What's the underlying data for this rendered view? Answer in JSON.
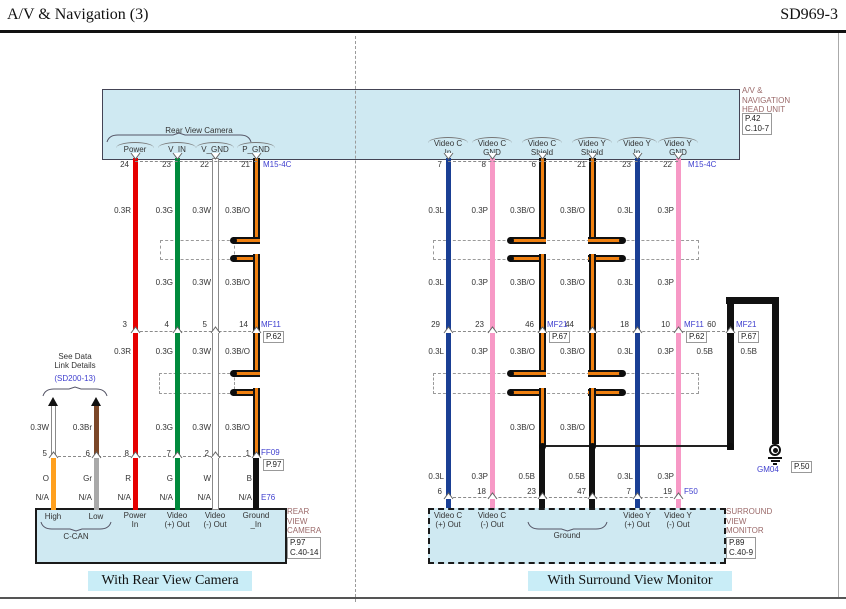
{
  "page": {
    "title": "A/V & Navigation (3)",
    "code": "SD969-3",
    "captions": {
      "left": "With Rear View Camera",
      "right": "With Surround View Monitor"
    }
  },
  "colors": {
    "box_fill": "#cfe9f2",
    "connector_text": "#4040cf",
    "component_text": "#9b6a6a",
    "wire_red": "#e60000",
    "wire_green": "#008a3c",
    "wire_white": "#ffffff",
    "wire_blue": "#1a3f94",
    "wire_pink": "#f799c6",
    "wire_orange": "#ffa01e",
    "wire_gray": "#a9a9a9",
    "wire_brown": "#7b4728",
    "wire_black": "#111111",
    "shield_core": "#f08010"
  },
  "head_unit": {
    "name": "A/V &\nNAVIGATION\nHEAD UNIT",
    "ref": "P.42\nC.10-7",
    "connector": "M15-4C",
    "left_group_label": "Rear View Camera",
    "left_pins": [
      {
        "num": "24",
        "label": "Power"
      },
      {
        "num": "23",
        "label": "V_IN"
      },
      {
        "num": "22",
        "label": "V_GND"
      },
      {
        "num": "21",
        "label": "P_GND"
      }
    ],
    "right_pins": [
      {
        "num": "7",
        "label": "Video C\nIn"
      },
      {
        "num": "8",
        "label": "Video C\nGND"
      },
      {
        "num": "6",
        "label": "Video C\nShield"
      },
      {
        "num": "21",
        "label": "Video Y\nShield"
      },
      {
        "num": "23",
        "label": "Video Y\nIn"
      },
      {
        "num": "22",
        "label": "Video Y\nGND"
      }
    ]
  },
  "left_circuit": {
    "mid_connector": {
      "name": "MF11",
      "ref": "P.62",
      "pins": [
        "3",
        "4",
        "5",
        "14"
      ]
    },
    "lower_connector": {
      "name": "FF09",
      "ref": "P.97",
      "pins": [
        "5",
        "6",
        "8",
        "7",
        "2",
        "1"
      ]
    },
    "device_connector": "E76",
    "size_row1": [
      "0.3R",
      "0.3G",
      "0.3W",
      "0.3B/O"
    ],
    "size_row2": [
      "0.3G",
      "0.3W",
      "0.3B/O"
    ],
    "size_row3": [
      "0.3R",
      "0.3G",
      "0.3W",
      "0.3B/O"
    ],
    "size_row4": [
      "0.3G",
      "0.3W",
      "0.3B/O"
    ],
    "color_row": [
      "O",
      "Gr",
      "R",
      "G",
      "W",
      "B"
    ],
    "na_row": [
      "N/A",
      "N/A",
      "N/A",
      "N/A",
      "N/A",
      "N/A"
    ],
    "datalink": {
      "note": "See Data\nLink Details",
      "note_ref": "(SD200-13)",
      "sizes": [
        "0.3W",
        "0.3Br"
      ]
    },
    "camera": {
      "name": "REAR\nVIEW\nCAMERA",
      "ref": "P.97\nC.40-14",
      "group_label": "C-CAN",
      "pins": [
        "High",
        "Low",
        "Power\nIn",
        "Video\n(+) Out",
        "Video\n(-) Out",
        "Ground\n_In"
      ]
    }
  },
  "right_circuit": {
    "mid_pins": [
      "29",
      "23",
      "46",
      "44",
      "18",
      "10",
      "60"
    ],
    "mid_connectors": [
      {
        "name": "MF21",
        "ref": "P.67"
      },
      {
        "name": "MF11",
        "ref": "P.62"
      },
      {
        "name": "MF21",
        "ref": "P.67"
      }
    ],
    "lower_pins": [
      "6",
      "18",
      "23",
      "47",
      "7",
      "19"
    ],
    "lower_connector": "F50",
    "ground_point": {
      "name": "GM04",
      "ref": "P.50"
    },
    "size_row1": [
      "0.3L",
      "0.3P",
      "0.3B/O",
      "0.3B/O",
      "0.3L",
      "0.3P"
    ],
    "size_row2": [
      "0.3L",
      "0.3P",
      "0.3B/O",
      "0.3B/O",
      "0.3L",
      "0.3P"
    ],
    "size_row3": [
      "0.3L",
      "0.3P",
      "0.3B/O",
      "0.3B/O",
      "0.3L",
      "0.3P",
      "0.5B",
      "0.5B"
    ],
    "size_row4": [
      "0.3B/O",
      "0.3B/O"
    ],
    "size_row5": [
      "0.3L",
      "0.3P",
      "0.5B",
      "0.5B",
      "0.3L",
      "0.3P"
    ],
    "monitor": {
      "name": "SURROUND\nVIEW\nMONITOR",
      "ref": "P.89\nC.40-9",
      "group_label": "Ground",
      "pins": [
        "Video C\n(+) Out",
        "Video C\n(-) Out",
        "Video Y\n(+) Out",
        "Video Y\n(-) Out"
      ]
    }
  }
}
